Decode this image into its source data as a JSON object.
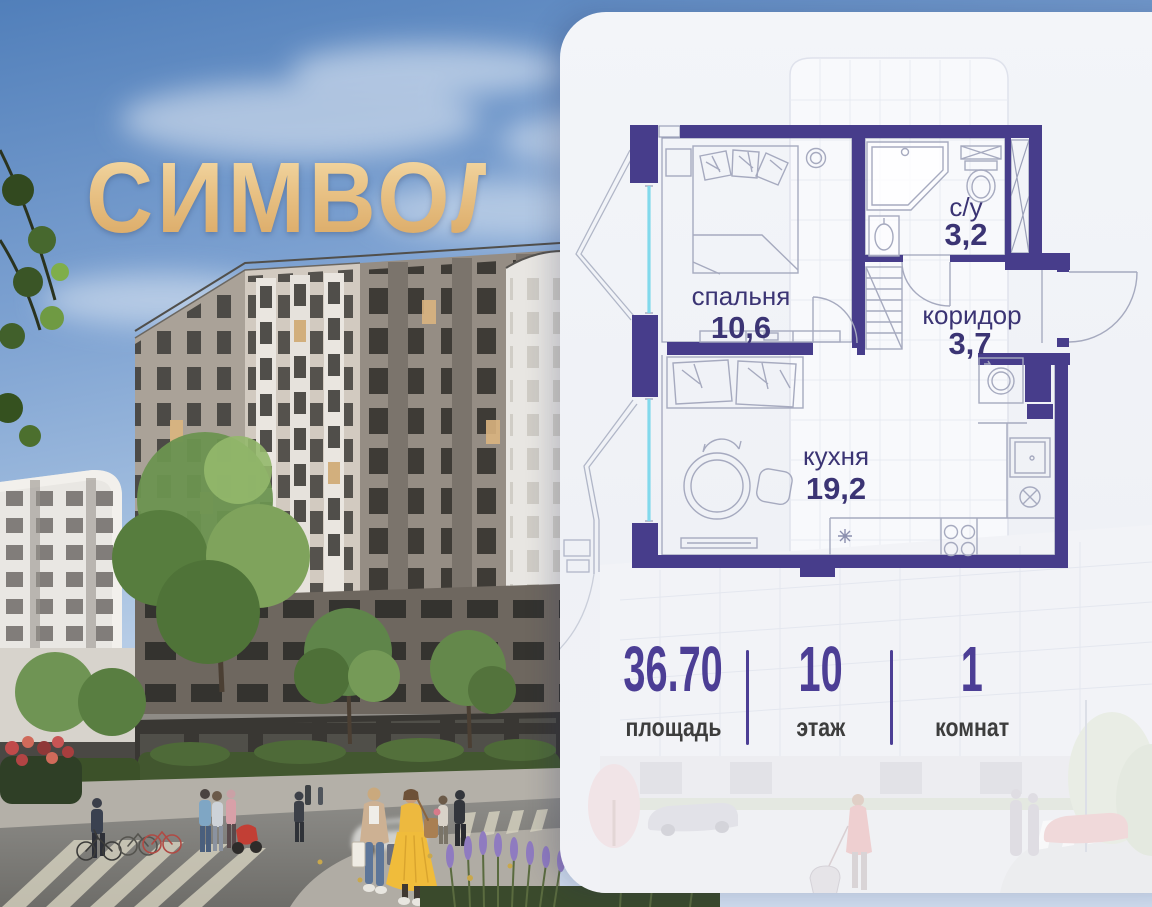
{
  "brand": {
    "logo": "СИМВОЛ"
  },
  "plan": {
    "rooms": [
      {
        "name": "спальня",
        "area": "10,6"
      },
      {
        "name": "с/у",
        "area": "3,2"
      },
      {
        "name": "коридор",
        "area": "3,7"
      },
      {
        "name": "кухня",
        "area": "19,2"
      }
    ]
  },
  "stats": {
    "area": {
      "value": "36.70",
      "label": "площадь"
    },
    "floor": {
      "value": "10",
      "label": "этаж"
    },
    "rooms": {
      "value": "1",
      "label": "комнат"
    }
  },
  "colors": {
    "wall_purple": "#473d8b",
    "plan_text": "#3b3474",
    "stats_accent": "#4c3e95",
    "logo_gold": "#e8c184",
    "glazing_cyan": "#82d9ec",
    "panel_bg": "#f1f3f7"
  }
}
